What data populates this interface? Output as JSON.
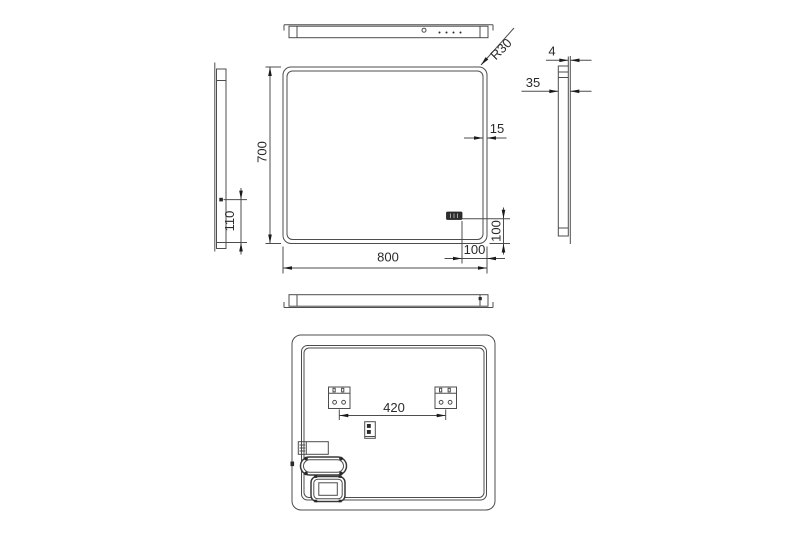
{
  "drawing": {
    "type": "technical-drawing",
    "subject": "led-mirror-multiview",
    "line_color": "#4d4d4d",
    "text_color": "#2a2a2a",
    "background": "#ffffff"
  },
  "dimensions": {
    "corner_radius": "R30",
    "glass_thickness": "4",
    "frame_depth": "35",
    "led_border_width": "15",
    "mirror_height": "700",
    "sensor_height_from_bottom": "110",
    "mirror_width": "800",
    "switch_offset_bottom": "100",
    "switch_offset_right": "100",
    "bracket_spacing": "420"
  }
}
